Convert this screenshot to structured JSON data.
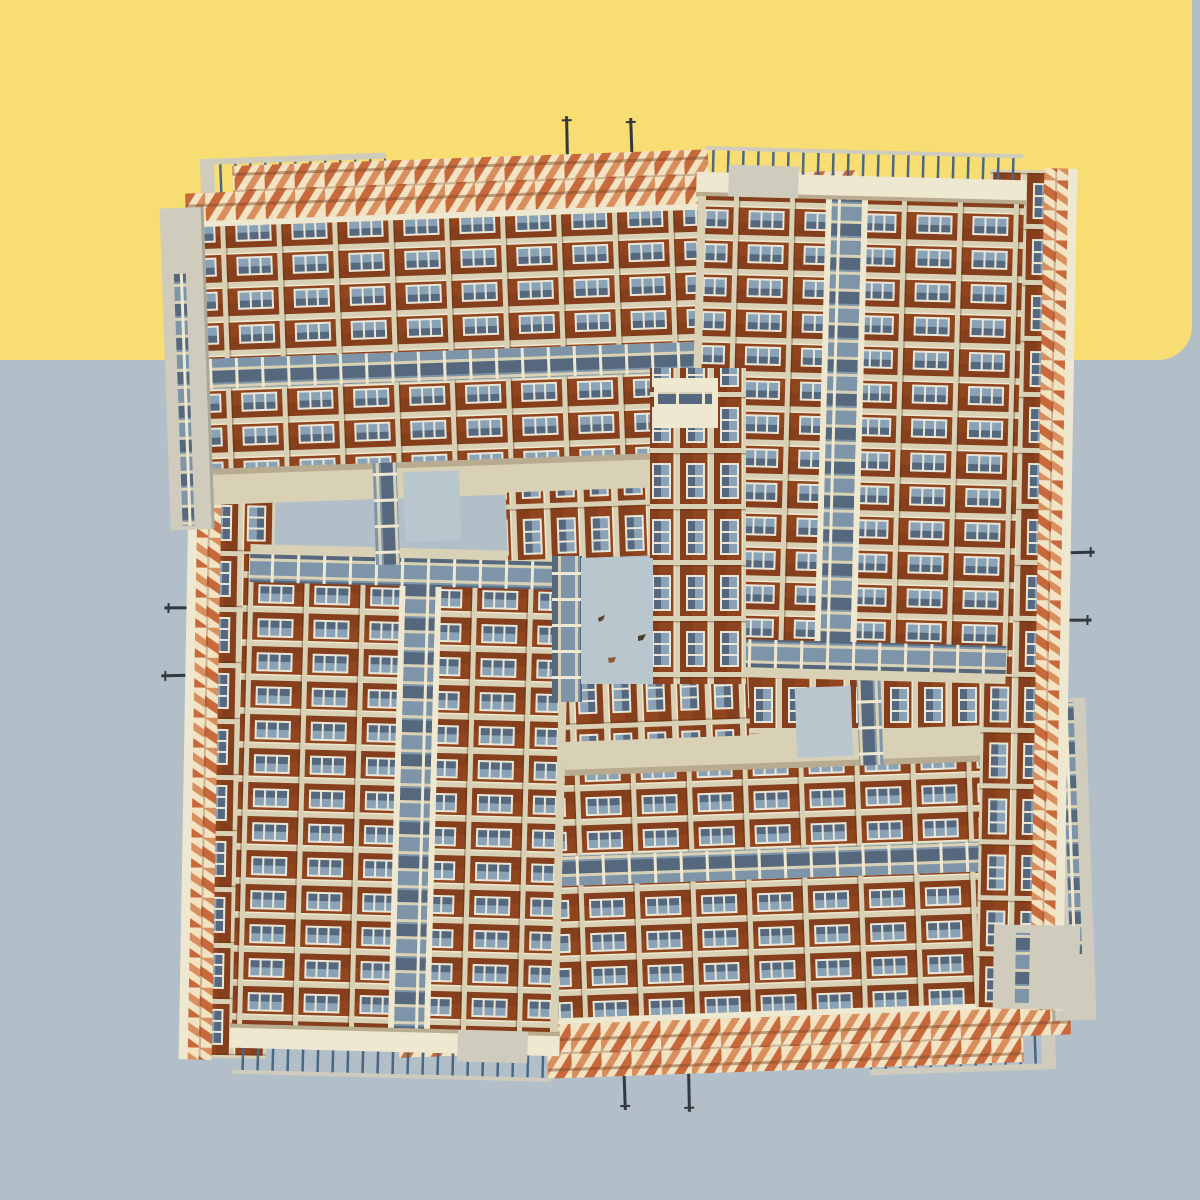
{
  "scene": {
    "kind": "photo-collage-artwork",
    "elements": {
      "sky_top": "yellow rounded band",
      "sky_bottom": "grey field",
      "collage": "four brick apartment slabs interlocked in a pinwheel",
      "center_gap": "small rectangle of sky with three bird specks",
      "antenna_count": 8,
      "bird_speck_count": 3
    }
  },
  "colors": {
    "yellow": "#f8dd72",
    "grey": "#b2bfc8",
    "sky-hole": "#b9c6ce",
    "brick": "#91451f",
    "concrete": "#d8d1b6",
    "concrete-bright": "#efe8d0",
    "grey-block": "#cfccbd",
    "parapet-base": "#f2e3c3",
    "parapet-red": "#c8693c",
    "parapet-red-light": "#d98e5e",
    "glass": "#7e95a9",
    "glass-dark": "#55687d",
    "window-frame": "#e9e6d8",
    "window-glass": "#8aa2b6",
    "railing": "#4a6784",
    "antenna": "#33383e"
  }
}
